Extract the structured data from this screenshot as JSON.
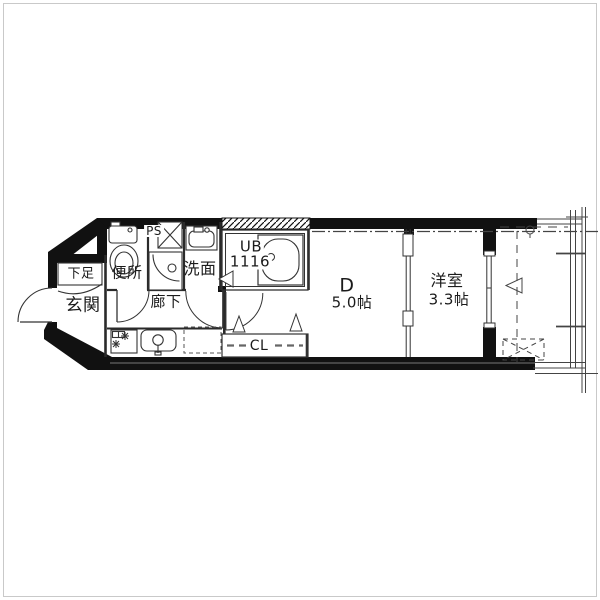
{
  "floor_plan": {
    "labels": {
      "entrance": "玄関",
      "shoe_storage": "下足",
      "toilet": "便所",
      "pipe_space": "PS",
      "washroom": "洗面",
      "unit_bath": "UB",
      "unit_bath_size": "1116",
      "corridor": "廊下",
      "dining": "D",
      "dining_area": "5.0帖",
      "western_room": "洋室",
      "western_room_area": "3.3帖",
      "closet": "CL"
    },
    "colors": {
      "wall": "#111111",
      "line": "#333333",
      "background": "#ffffff"
    }
  }
}
